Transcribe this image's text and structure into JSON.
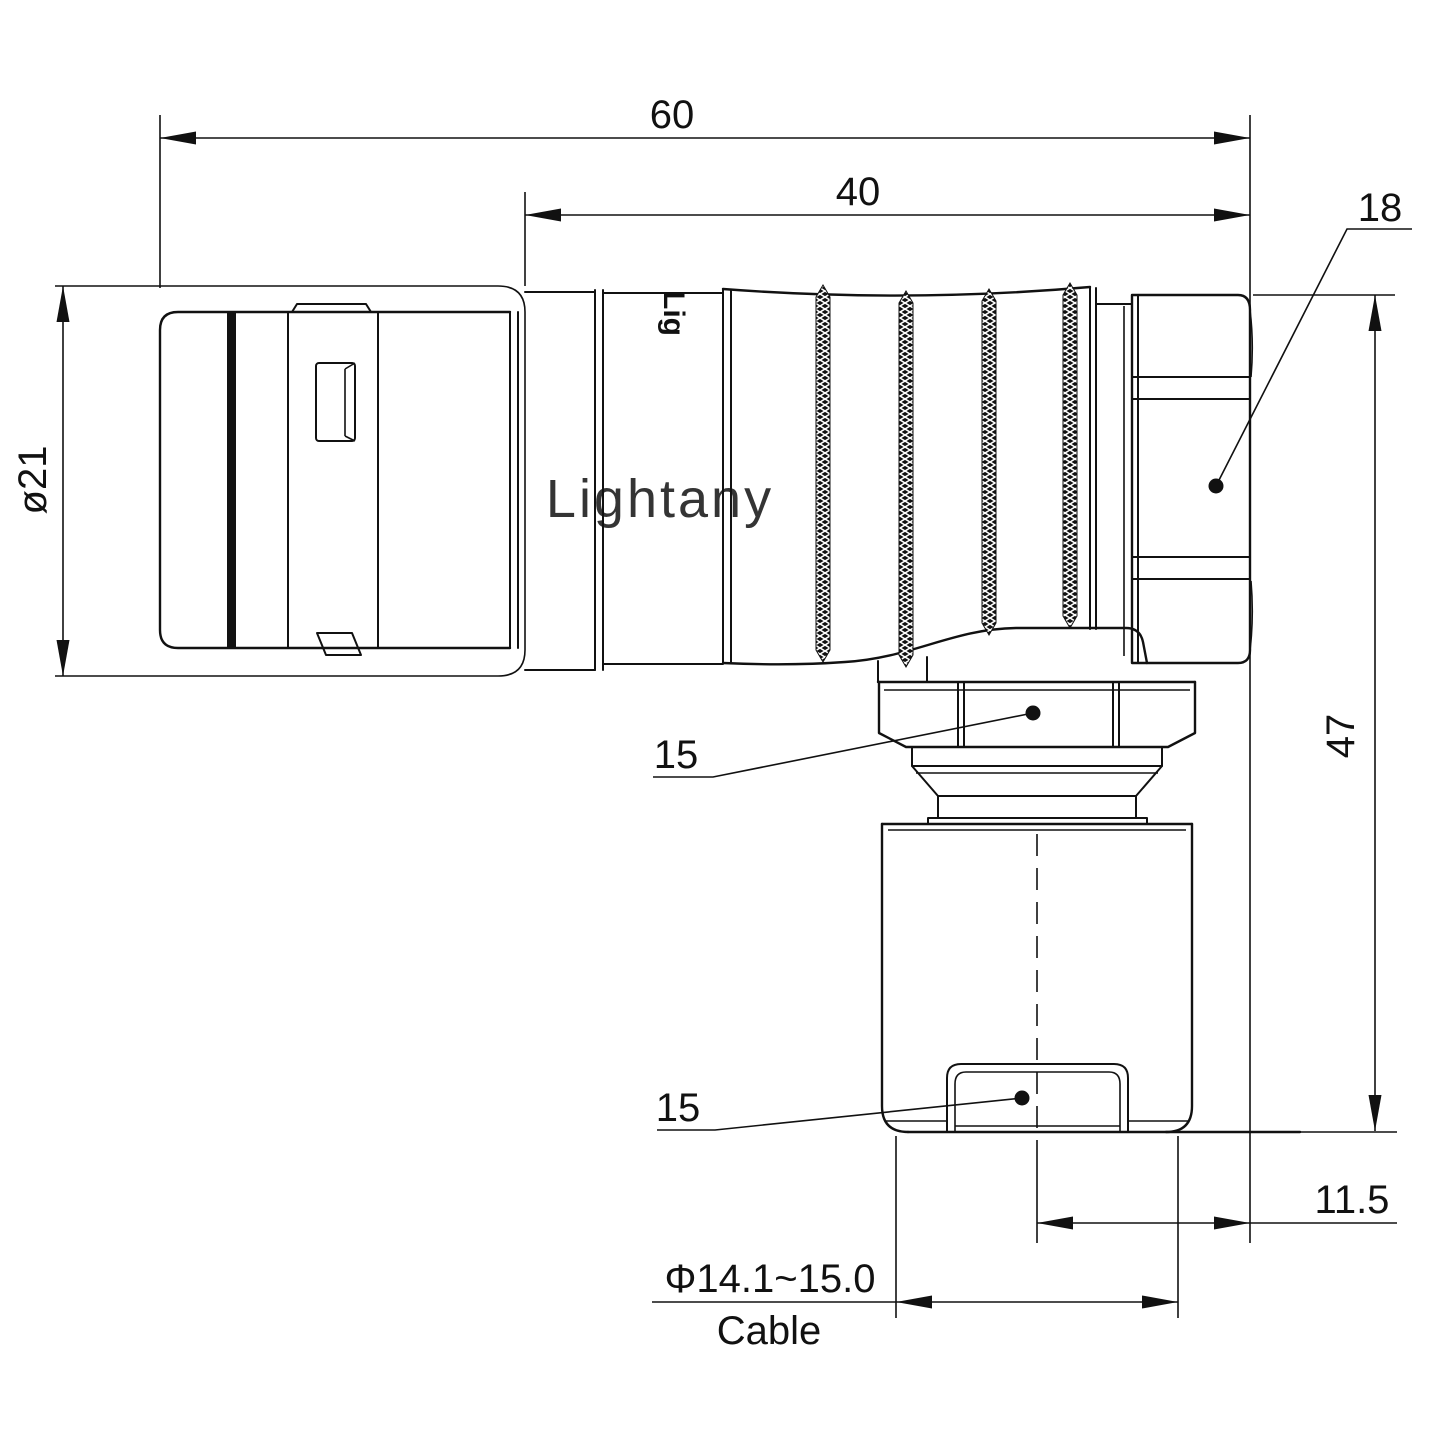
{
  "page": {
    "background": "#ffffff",
    "line_color": "#111111"
  },
  "watermark": {
    "text": "Lightany",
    "color": "#f5c3c1"
  },
  "engraving": {
    "text": "Lig"
  },
  "dimensions": {
    "overall_length": "60",
    "grip_length": "40",
    "backshell_nut": "18",
    "shell_diameter": "ø21",
    "right_angle_height": "47",
    "axis_to_face_offset": "11.5",
    "coupling_nut_flats": "15",
    "cable_clamp_flats": "15",
    "cable_diameter_range": "Φ14.1~15.0",
    "cable_label": "Cable"
  }
}
